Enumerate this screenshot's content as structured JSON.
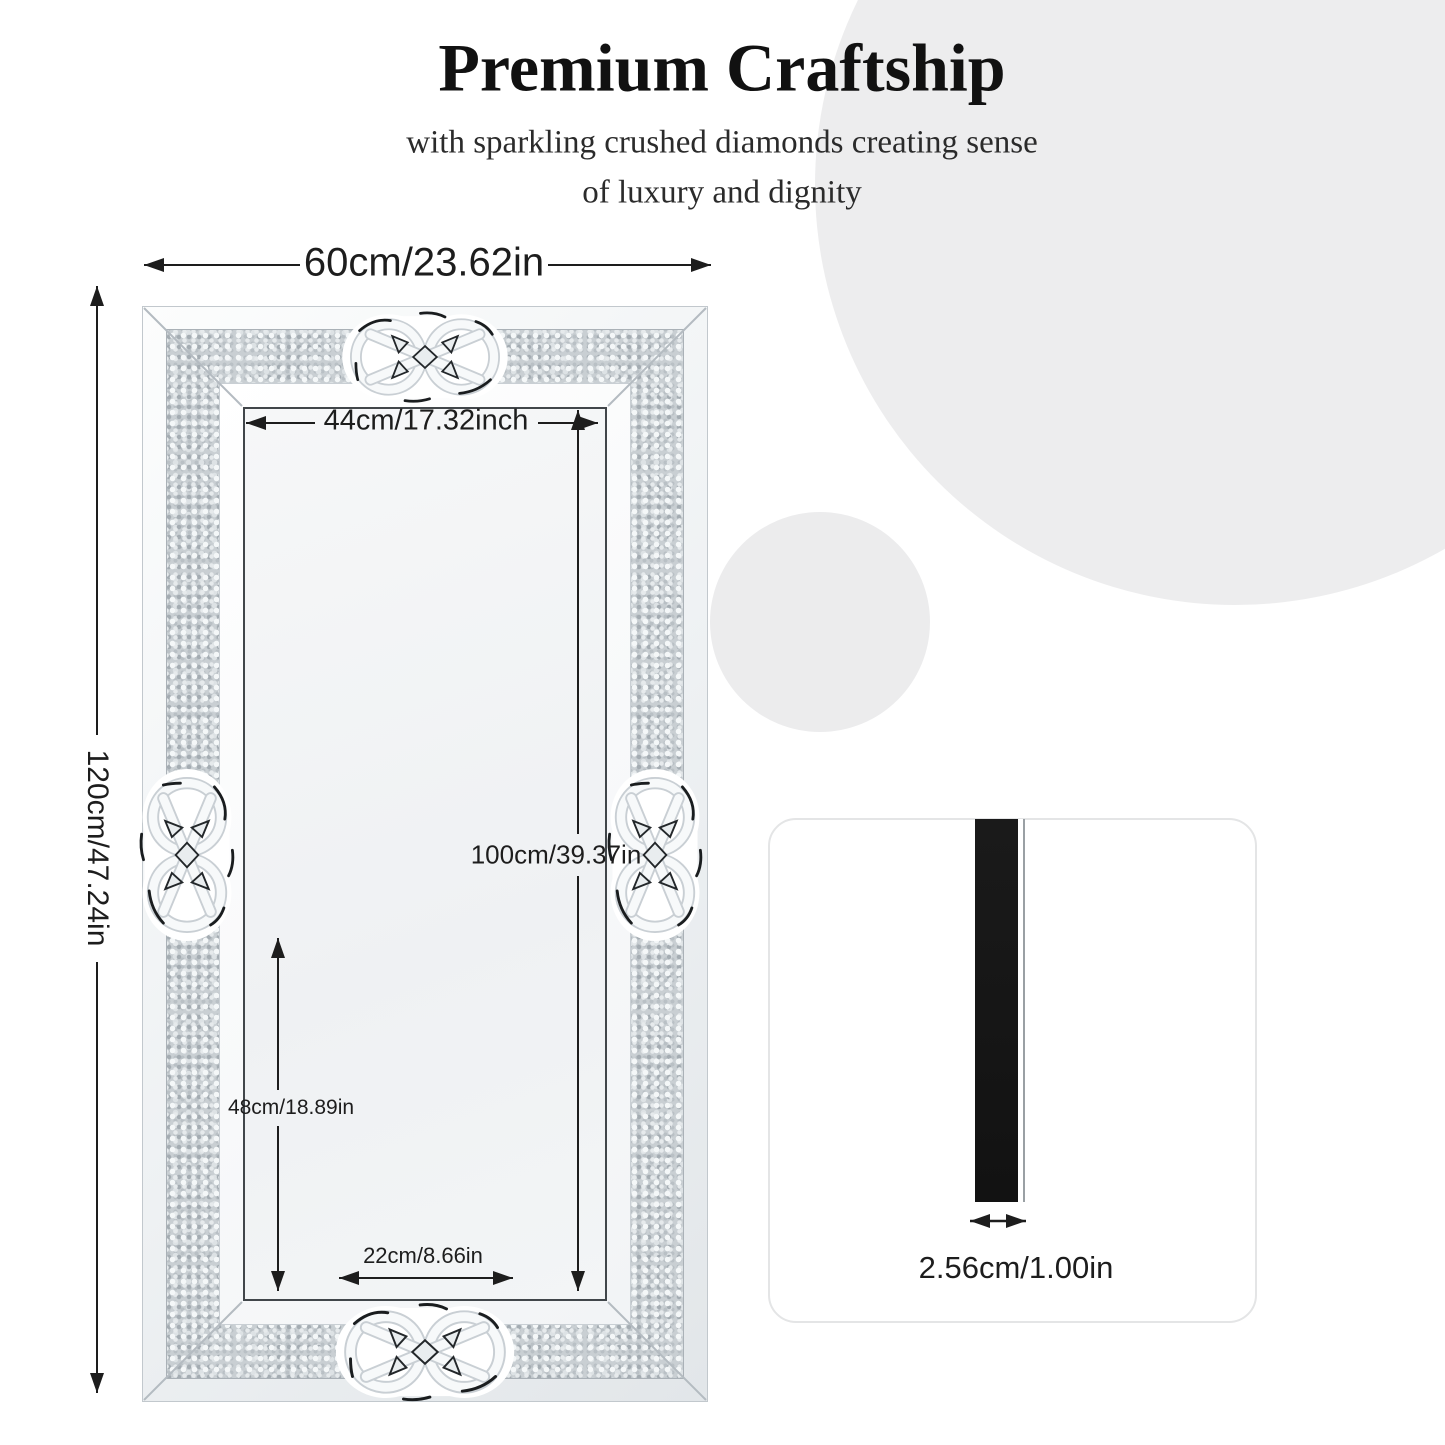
{
  "header": {
    "title": "Premium Craftship",
    "subtitle_line1": "with sparkling crushed diamonds creating sense",
    "subtitle_line2": "of luxury and dignity"
  },
  "mirror": {
    "dimensions": {
      "outer_width": "60cm/23.62in",
      "outer_height": "120cm/47.24in",
      "inner_width": "44cm/17.32inch",
      "inner_height": "100cm/39.37in",
      "lower_section_height": "48cm/18.89in",
      "bottom_inner_width": "22cm/8.66in"
    }
  },
  "thickness_panel": {
    "thickness": "2.56cm/1.00in"
  },
  "colors": {
    "dimension_ink": "#1d1d1d",
    "background_circle": "#ededee",
    "diamond_band_base": "#c9cfd3",
    "profile_bar": "#141414"
  }
}
